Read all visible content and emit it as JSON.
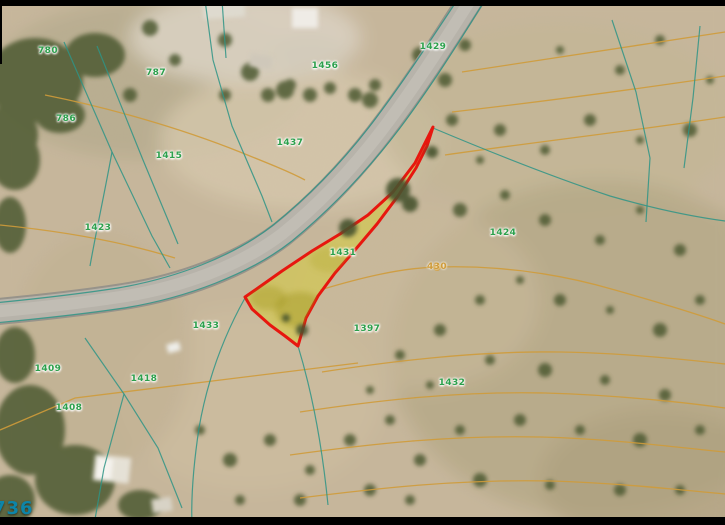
{
  "map": {
    "highlighted_parcel_number": "1431",
    "corner_label": "736"
  },
  "colors": {
    "parcel_outline": "#e7170f",
    "parcel_fill": "#d8ce2e",
    "cadastral_line": "#2e9486",
    "contour_line": "#cf9b3a",
    "parcel_label_text": "#2ca04c",
    "corner_label_text": "#0d85a8"
  },
  "parcel_labels": [
    {
      "text": "780",
      "x": 48,
      "y": 51,
      "kind": "parcel"
    },
    {
      "text": "787",
      "x": 156,
      "y": 73,
      "kind": "parcel"
    },
    {
      "text": "786",
      "x": 66,
      "y": 119,
      "kind": "parcel"
    },
    {
      "text": "1415",
      "x": 169,
      "y": 156,
      "kind": "parcel"
    },
    {
      "text": "1423",
      "x": 98,
      "y": 228,
      "kind": "parcel"
    },
    {
      "text": "1456",
      "x": 325,
      "y": 66,
      "kind": "parcel"
    },
    {
      "text": "1429",
      "x": 433,
      "y": 47,
      "kind": "parcel"
    },
    {
      "text": "1437",
      "x": 290,
      "y": 143,
      "kind": "parcel"
    },
    {
      "text": "1431",
      "x": 343,
      "y": 253,
      "kind": "parcel"
    },
    {
      "text": "1424",
      "x": 503,
      "y": 233,
      "kind": "parcel"
    },
    {
      "text": "1433",
      "x": 206,
      "y": 326,
      "kind": "parcel"
    },
    {
      "text": "1397",
      "x": 367,
      "y": 329,
      "kind": "parcel"
    },
    {
      "text": "1432",
      "x": 452,
      "y": 383,
      "kind": "parcel"
    },
    {
      "text": "1409",
      "x": 48,
      "y": 369,
      "kind": "parcel"
    },
    {
      "text": "1418",
      "x": 144,
      "y": 379,
      "kind": "parcel"
    },
    {
      "text": "1408",
      "x": 69,
      "y": 408,
      "kind": "parcel"
    },
    {
      "text": "430",
      "x": 437,
      "y": 267,
      "kind": "contour"
    }
  ]
}
